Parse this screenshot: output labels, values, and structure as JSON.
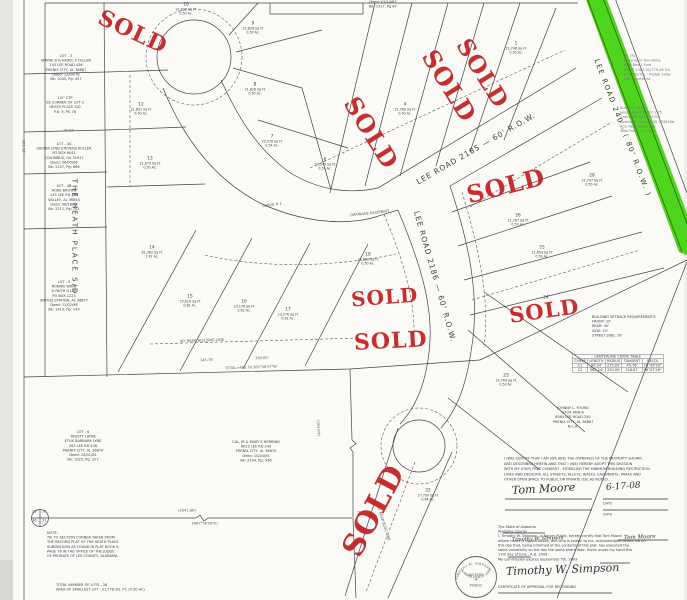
{
  "page": {
    "bg": "#fbfaf7",
    "line_color": "#43424a",
    "sold_color": "#c32020",
    "road_green": "#46d312"
  },
  "sold_stamps": [
    {
      "text": "SOLD",
      "x": 96,
      "y": 21,
      "rot": 25,
      "fs": 22
    },
    {
      "text": "SOLD",
      "x": 331,
      "y": 121,
      "rot": 58,
      "fs": 24
    },
    {
      "text": "SOLD",
      "x": 409,
      "y": 74,
      "rot": 58,
      "fs": 24
    },
    {
      "text": "SOLD",
      "x": 444,
      "y": 62,
      "rot": 58,
      "fs": 23
    },
    {
      "text": "SOLD",
      "x": 466,
      "y": 174,
      "rot": -14,
      "fs": 24
    },
    {
      "text": "SOLD",
      "x": 351,
      "y": 287,
      "rot": -4,
      "fs": 20
    },
    {
      "text": "SOLD",
      "x": 354,
      "y": 330,
      "rot": -3,
      "fs": 22
    },
    {
      "text": "SOLD",
      "x": 509,
      "y": 300,
      "rot": -8,
      "fs": 21
    },
    {
      "text": "SOLD",
      "x": 325,
      "y": 496,
      "rot": -62,
      "fs": 30
    }
  ],
  "road_labels": [
    {
      "t": "LEE ROAD 2185   —   60' R.O.W.",
      "x": 408,
      "y": 144,
      "r": -30,
      "fs": 7.5,
      "ls": 1,
      "c": "#3c3c44"
    },
    {
      "t": "LEE ROAD 2186   —   60' R.O.W.",
      "x": 367,
      "y": 272,
      "r": 74,
      "fs": 7.5,
      "ls": 1,
      "c": "#3c3c44"
    },
    {
      "t": "LEE  ROAD  240  -  ( 80'  R.O.W. )",
      "x": 549,
      "y": 124,
      "r": 69,
      "fs": 7,
      "ls": 1.5,
      "c": "#1c4a08"
    },
    {
      "t": "THE  HEATH  PLACE  S/D",
      "x": 16,
      "y": 233,
      "r": 90,
      "fs": 7,
      "ls": 2,
      "c": "#3c3c44"
    }
  ],
  "lot_labels": [
    {
      "n": "10",
      "sf": "21,826 Sq Ft",
      "ac": "0.50 Ac.",
      "cx": 186,
      "y": 2
    },
    {
      "n": "9",
      "sf": "21,826 Sq Ft",
      "ac": "0.50 Ac.",
      "cx": 253,
      "y": 21
    },
    {
      "n": "8",
      "sf": "21,826 Sq Ft",
      "ac": "0.50 Ac.",
      "cx": 255,
      "y": 82
    },
    {
      "n": "7",
      "sf": "23,578 Sq Ft",
      "ac": "0.54 Ac.",
      "cx": 272,
      "y": 134
    },
    {
      "n": "6",
      "sf": "23,579 Sq Ft",
      "ac": "0.53 Ac.",
      "cx": 325,
      "y": 157
    },
    {
      "n": "12",
      "sf": "21,801 Sq Ft",
      "ac": "0.50 Ac.",
      "cx": 141,
      "y": 102
    },
    {
      "n": "13",
      "sf": "21,875 Sq Ft",
      "ac": "0.50 Ac.",
      "cx": 150,
      "y": 156
    },
    {
      "n": "14",
      "sf": "61,362 Sq Ft",
      "ac": "1.42 Ac.",
      "cx": 152,
      "y": 245
    },
    {
      "n": "15",
      "sf": "25,616 Sq Ft",
      "ac": "0.62 Ac.",
      "cx": 190,
      "y": 294
    },
    {
      "n": "16",
      "sf": "23,278 Sq Ft",
      "ac": "0.62 Ac.",
      "cx": 244,
      "y": 299
    },
    {
      "n": "17",
      "sf": "23,278 Sq Ft",
      "ac": "0.61 Ac.",
      "cx": 288,
      "y": 307
    },
    {
      "n": "18",
      "sf": "21,890 Sq Ft",
      "ac": "0.50 Ac.",
      "cx": 368,
      "y": 252
    },
    {
      "n": "4",
      "sf": "21,780 Sq Ft",
      "ac": "0.50 Ac.",
      "cx": 405,
      "y": 102
    },
    {
      "n": "1",
      "sf": "22,748 Sq Ft",
      "ac": "0.50 Ac.",
      "cx": 516,
      "y": 41
    },
    {
      "n": "28",
      "sf": "21,747 Sq Ft",
      "ac": "0.50 Ac.",
      "cx": 592,
      "y": 173
    },
    {
      "n": "26",
      "sf": "21,767 Sq Ft",
      "ac": "0.50 Ac.",
      "cx": 518,
      "y": 213
    },
    {
      "n": "25",
      "sf": "21,854 Sq Ft",
      "ac": "0.50 Ac.",
      "cx": 542,
      "y": 245
    },
    {
      "n": "24",
      "sf": "",
      "ac": "",
      "cx": 546,
      "y": 295
    },
    {
      "n": "23",
      "sf": "21,764 Sq Ft",
      "ac": "0.50 Ac.",
      "cx": 506,
      "y": 373
    },
    {
      "n": "22",
      "sf": "27,709 Sq Ft",
      "ac": "0.64 Ac.",
      "cx": 428,
      "y": 488
    },
    {
      "n": "21",
      "sf": "",
      "ac": "",
      "cx": 360,
      "y": 511
    }
  ],
  "text_blocks": [
    {
      "x": 24,
      "y": 54,
      "w": 84,
      "align": "center",
      "lines": [
        "LOT - 3",
        "WAYNE B & HAZEL S FULLER",
        "143 LEE ROAD 436",
        "PHENIX CITY, AL 36867",
        "Deed: 12/04/78",
        "Bk: 1045, Pg: 457"
      ]
    },
    {
      "x": 28,
      "y": 96,
      "w": 74,
      "align": "center",
      "lines": [
        "1/2\" CTP",
        "SE CORNER OF LOT 3",
        "HEATH PLACE S/D",
        "P.B. 9, PG 76"
      ]
    },
    {
      "x": 20,
      "y": 142,
      "w": 88,
      "align": "center",
      "lines": [
        "LOT - 4A",
        "SHIDRA LYNN STEVENS KOLLER",
        "PO BOX 6041",
        "COLUMBUS, GA 31917",
        "Deed: 06/05/06",
        "Bk: 2257, Pg: 866"
      ]
    },
    {
      "x": 28,
      "y": 184,
      "w": 72,
      "align": "center",
      "lines": [
        "LOT - 4B",
        "HOKE BROWN",
        "143 LEE RD 360",
        "VALLEY, AL 36854",
        "Deed: 06/16/01",
        "Bk: 2211, Pg: 702"
      ]
    },
    {
      "x": 24,
      "y": 280,
      "w": 80,
      "align": "center",
      "lines": [
        "LOT - 5",
        "RONNIE WINN",
        "& FAITH G LEE",
        "PO BOX 1223",
        "SMITHS STATION, AL 36877",
        "Deed: 11/02/98",
        "Bk: 1413, Pg: 143"
      ]
    },
    {
      "x": 40,
      "y": 430,
      "w": 86,
      "align": "center",
      "lines": [
        "LOT - 6",
        "TRUSTY LAYNE",
        "ETUX BARBARA LYNE",
        "263 LEE RD 436",
        "PHENIX CITY, AL 36870",
        "Deed: 10/01/04",
        "Bk: 1025, Pg: 327"
      ]
    },
    {
      "x": 194,
      "y": 440,
      "w": 124,
      "align": "center",
      "lines": [
        "CAL, JR & MARY E HERRING",
        "6023 LEE RD 240",
        "PHENIX CITY, AL 36870",
        "Deed: 10/24/05",
        "Bk: 2294, Pg: 936"
      ]
    },
    {
      "x": 526,
      "y": 406,
      "w": 94,
      "align": "center",
      "lines": [
        "JOHNNY L. YOUNG",
        "ETUX ANN B",
        "6084 LEE ROAD 240",
        "PHENIX CITY, AL 36867",
        "N.C.A."
      ]
    },
    {
      "x": 47,
      "y": 531,
      "w": 114,
      "align": "left",
      "lines": [
        "NOTE:",
        "TIE TO SECTION CORNER TAKEN FROM",
        "THE RECORD PLAT OF THE HEATH PLACE",
        "SUBDIVISION AS FOUND IN PLAT BOOK 9,",
        "PAGE 76 IN THE OFFICE OF THE JUDGE",
        "OF PROBATE OF LEE COUNTY, ALABAMA."
      ]
    },
    {
      "x": 56,
      "y": 583,
      "w": 200,
      "align": "left",
      "lines": [
        "TOTAL NUMBER OF LOTS    -    28",
        "AREA OF SMALLEST LOT    -    21,778 SQ. FT. (0.50 AC)"
      ]
    },
    {
      "x": 350,
      "y": 0,
      "w": 66,
      "align": "center",
      "lines": [
        "Deed: 07/14/87",
        "Bk: 1317, Pg 87"
      ]
    },
    {
      "x": 624,
      "y": 54,
      "w": 80,
      "align": "left",
      "faint": true,
      "lines": [
        "31    7%",
        "Reserve in the Home",
        "RLW  Box 1 Fore",
        "58-C7-1265 02/779-45 5%",
        "BCG Electric - Prefab 5x6w",
        "Lee Counter AL"
      ]
    },
    {
      "x": 620,
      "y": 106,
      "w": 84,
      "align": "left",
      "faint": true,
      "lines": [
        "BudaPrk 35/36",
        "Jane/Colbert 8350C / 75",
        "Grant 345-0538/75315",
        "Assessed 14-c5-3438 234616b",
        "ACC Respiratory Fee",
        "Total Fees) - $ 35.00"
      ]
    },
    {
      "x": 592,
      "y": 315,
      "w": 92,
      "align": "left",
      "lines": [
        "BUILDING SETBACK REQUIREMENTS:",
        "FRONT:  25'",
        "REAR:  40'",
        "SIDE:  10'",
        "STREET SIDE:  20'"
      ]
    },
    {
      "x": 504,
      "y": 456,
      "w": 172,
      "align": "left",
      "lh": 1.5,
      "lines": [
        "I (WE) CERTIFY THAT I AM (WE ARE) THE OWNER(S) OF THE PROPERTY SHOWN",
        "AND DESCRIBED HEREIN AND THAT I (WE) HEREBY ADOPT THIS DIVISION",
        "WITH MY (OUR) FREE CONSENT , ESTABLISH THE MINIMUM BUILDING RESTRICTION",
        "LINES AND DEDICATE ALL STREETS, ALLEYS, WALKS, EASEMENTS, PARKS AND",
        "OTHER OPEN SPACE TO PUBLIC OR PRIVATE USE AS NOTED."
      ]
    },
    {
      "x": 498,
      "y": 525,
      "w": 190,
      "align": "left",
      "lh": 1.32,
      "lines": [
        "The State of Alabama",
        "     Alabama      County",
        "I,  Timothy W. Simpson , a Notary Public, hereby certify that    Tom Moore",
        "whose name is signed above, and who is known to me, acknowledged before me on",
        "this day that, being informed of the contents of this plat, has executed the",
        "same voluntarily on the day the same bears date.  Given under my hand this",
        "17th  day of  June , A.D.  2008 .",
        "My commission expires September  7th, 2009"
      ]
    }
  ],
  "signatures": [
    {
      "t": "Tom Moore",
      "x": 512,
      "y": 484,
      "fs": 11,
      "r": -3
    },
    {
      "t": "6-17-08",
      "x": 606,
      "y": 483,
      "fs": 9,
      "r": -4
    },
    {
      "t": "Timothy W. Simpson",
      "x": 512,
      "y": 537,
      "fs": 5,
      "r": -2
    },
    {
      "t": "Tom Moore",
      "x": 624,
      "y": 535,
      "fs": 5.5,
      "r": -2
    },
    {
      "t": "Timothy W. Simpson",
      "x": 506,
      "y": 565,
      "fs": 11,
      "r": -2
    }
  ],
  "dim_labels": [
    {
      "t": "TOTAL=485.76   S87°06'07\"W",
      "x": 225,
      "y": 366,
      "r": -2
    },
    {
      "t": "145.78'",
      "x": 200,
      "y": 358,
      "r": -2
    },
    {
      "t": "150.00'",
      "x": 255,
      "y": 356,
      "r": -2
    },
    {
      "t": "(2641.86')",
      "x": 178,
      "y": 508,
      "r": 0
    },
    {
      "t": "(N87°58'06\"E)",
      "x": 192,
      "y": 521,
      "r": 0
    },
    {
      "t": "18.02'",
      "x": 63,
      "y": 128,
      "r": 0
    },
    {
      "t": "40' REAR BUILDING LINE",
      "x": 180,
      "y": 339,
      "r": -2
    },
    {
      "t": "40' REAR BLDG LINE",
      "x": 380,
      "y": 505,
      "r": 72
    },
    {
      "t": "CURVE # 1",
      "x": 262,
      "y": 204,
      "r": -8
    },
    {
      "t": "DRAINAGE EASEMENT",
      "x": 350,
      "y": 213,
      "r": -6
    },
    {
      "t": "25",
      "x": 32,
      "y": 509,
      "r": 0
    },
    {
      "t": "30",
      "x": 42,
      "y": 509,
      "r": 0
    },
    {
      "t": "36",
      "x": 32,
      "y": 518,
      "r": 0
    },
    {
      "t": "31",
      "x": 42,
      "y": 518,
      "r": 0
    },
    {
      "t": "DATE",
      "x": 603,
      "y": 501,
      "r": 0
    },
    {
      "t": "DATE",
      "x": 603,
      "y": 512,
      "r": 0
    },
    {
      "t": "302.18'",
      "x": 26,
      "y": 140,
      "r": 90
    },
    {
      "t": "(354.04')",
      "x": 320,
      "y": 420,
      "r": 86
    }
  ],
  "curve_table": {
    "title": "CENTERLINE CURVE TABLE",
    "headers": [
      "CURVE",
      "LENGTH",
      "RADIUS",
      "TANGENT",
      "DELTA"
    ],
    "rows": [
      [
        "C1",
        "90.04'",
        "275.00'",
        "45.76'",
        "18°45'50\""
      ],
      [
        "C2",
        "565.24'",
        "330.00'",
        "318.67'",
        "98°07'26\""
      ]
    ]
  },
  "certificate": {
    "approval": "CERTIFICATE OF APPROVAL FOR RECORDING"
  },
  "seal": {
    "top": "TIMOTHY W. SIMPSON",
    "bottom": "ALABAMA STATE AT LARGE",
    "center1": "NOTARY",
    "center2": "PUBLIC"
  }
}
